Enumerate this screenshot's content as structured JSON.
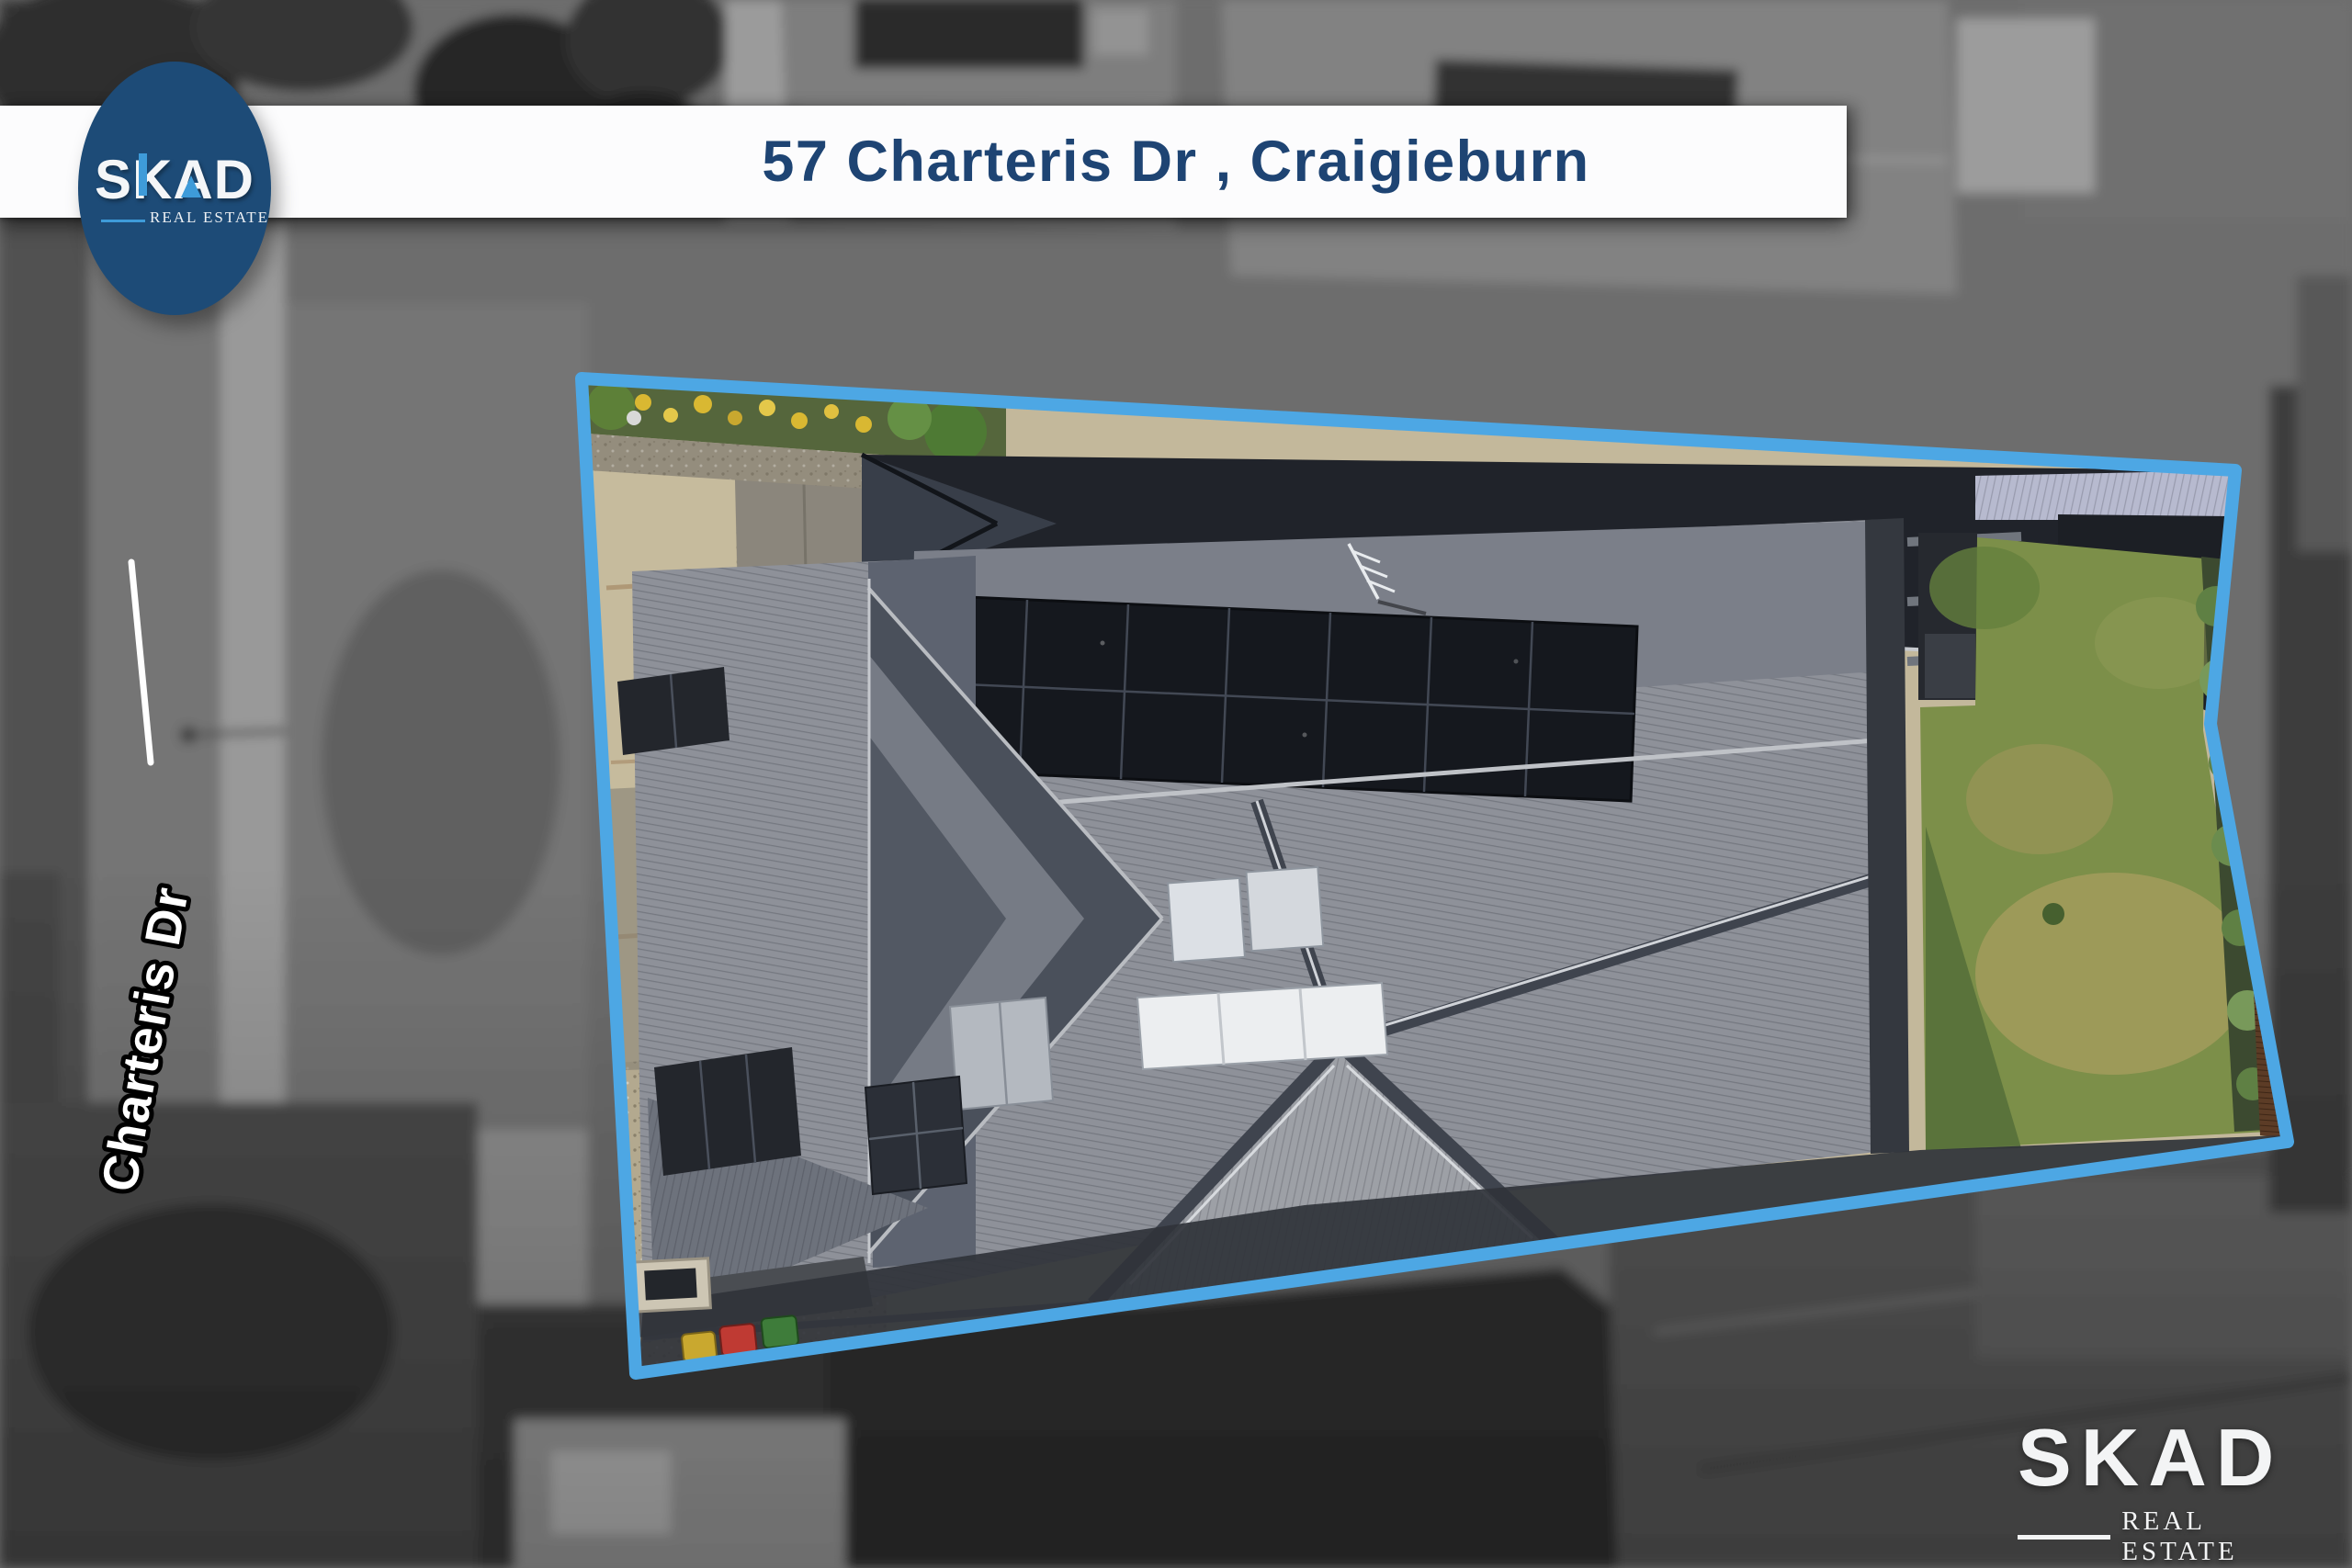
{
  "header": {
    "title": "57 Charteris Dr , Craigieburn"
  },
  "logo_badge": {
    "name": "SKAD",
    "tagline": "REAL ESTATE"
  },
  "watermark": {
    "name": "SKAD",
    "tagline": "REAL ESTATE"
  },
  "street": {
    "label": "Charteris Dr"
  },
  "property": {
    "boundary_color": "#4da7e4"
  },
  "colors": {
    "title_navy": "#1e4473",
    "badge_background": "#1d4b77",
    "logo_accent_blue": "#3e9bd9",
    "banner_white": "#fcfcfd"
  }
}
